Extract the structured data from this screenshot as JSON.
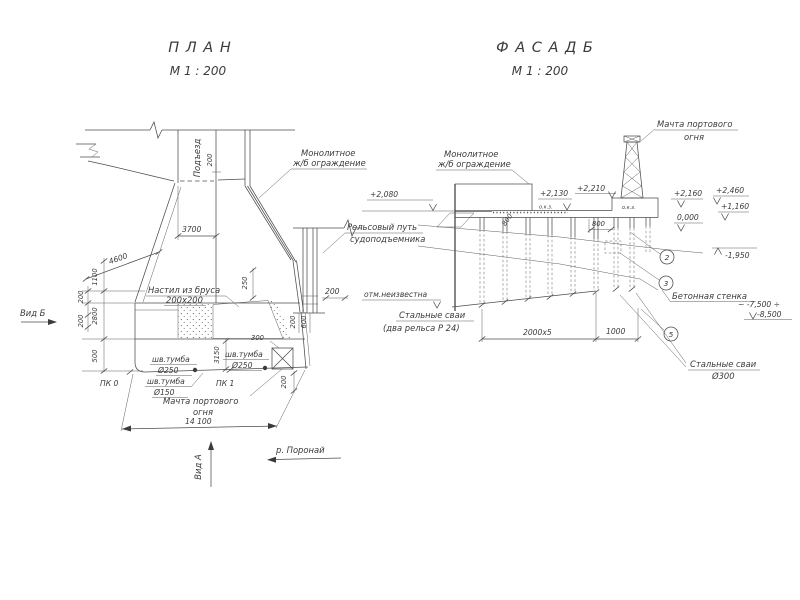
{
  "plan": {
    "title": "П Л А Н",
    "scale": "М 1 : 200",
    "road": "Подъезд",
    "labels": {
      "guard1": "Монолитное",
      "guard2": "ж/б ограждение",
      "deck1": "Настил из бруса",
      "deck2": "200х200",
      "rail1": "Рельсовый путь",
      "rail2": "судоподъемника",
      "mast1": "Мачта портового",
      "mast2": "огня",
      "pk0": "ПК 0",
      "pk1": "ПК 1",
      "view_b": "Вид Б",
      "view_a": "Вид А",
      "river": "р. Поронай"
    },
    "bollards": [
      {
        "name": "шв.тумба",
        "dia": "Ø250"
      },
      {
        "name": "шв.тумба",
        "dia": "Ø250"
      },
      {
        "name": "шв.тумба",
        "dia": "Ø150"
      }
    ],
    "dims": {
      "road_edge": "200",
      "width": "3700",
      "slope": "4600",
      "v1100": "1100",
      "v200a": "200",
      "v2800": "2800",
      "v200b": "200",
      "v500": "500",
      "step250": "250",
      "rail200": "200",
      "deck200": "200",
      "deck600": "600",
      "edge300": "300",
      "v3150": "3150",
      "mast200": "200",
      "total": "14 100"
    }
  },
  "facade": {
    "title": "Ф А С А Д   Б",
    "scale": "М 1 : 200",
    "labels": {
      "mast1": "Мачта портового",
      "mast2": "огня",
      "guard1": "Монолитное",
      "guard2": "ж/б ограждение",
      "okz1": "о.к.з.",
      "okz2": "о.к.з.",
      "unknown": "отм.неизвестна",
      "piles1": "Стальные сваи",
      "piles2": "(два рельса  Р 24)",
      "wall": "Бетонная стенка",
      "spiles1": "Стальные сваи",
      "spiles2": "Ø300"
    },
    "levels": {
      "p2080": "+2,080",
      "p2130": "+2,130",
      "p2210": "+2,210",
      "p2160": "+2,160",
      "p2460": "+2,460",
      "p1160": "+1,160",
      "zero": "0,000",
      "m1950": "-1,950",
      "m7500": "~ -7,500 ÷",
      "m8500": "-8,500"
    },
    "dims": {
      "d800a": "800",
      "d800b": "800",
      "d2000": "2000х5",
      "d1000": "1000"
    },
    "markers": [
      "2",
      "3",
      "5"
    ]
  }
}
